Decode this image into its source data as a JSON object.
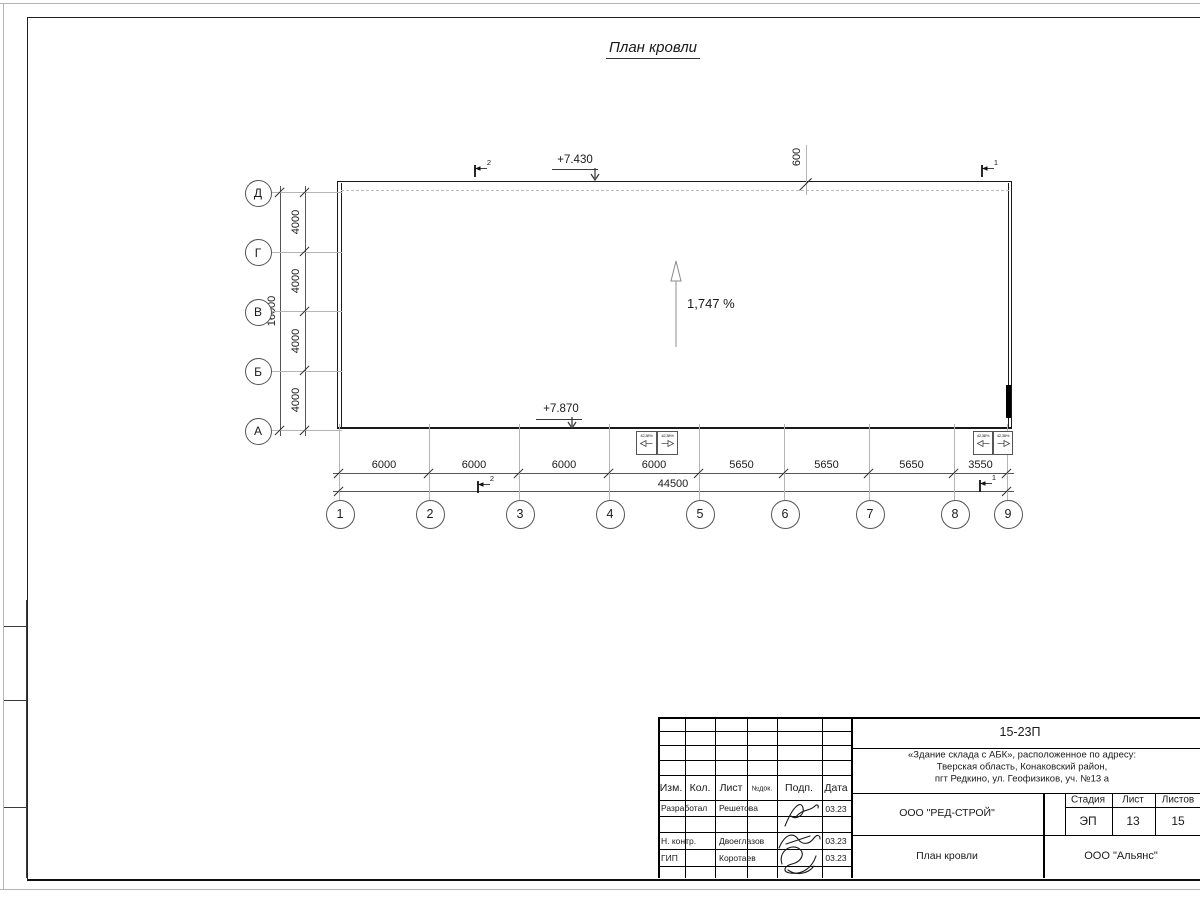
{
  "title": "План кровли",
  "drawing": {
    "elevation_top": "+7.430",
    "elevation_bottom": "+7.870",
    "slope_label": "1,747 %",
    "parapet_offset": "600",
    "section_markers": [
      "2",
      "1",
      "2",
      "1"
    ],
    "funnels": [
      {
        "label": "42,38%",
        "dir": "left"
      },
      {
        "label": "42,38%",
        "dir": "right"
      },
      {
        "label": "42,38%",
        "dir": "left"
      },
      {
        "label": "42,38%",
        "dir": "right"
      }
    ]
  },
  "axes": {
    "rows": [
      "Д",
      "Г",
      "В",
      "Б",
      "А"
    ],
    "row_dims": [
      "4000",
      "4000",
      "4000",
      "4000"
    ],
    "row_total": "16000",
    "cols": [
      "1",
      "2",
      "3",
      "4",
      "5",
      "6",
      "7",
      "8",
      "9"
    ],
    "col_dims": [
      "6000",
      "6000",
      "6000",
      "6000",
      "5650",
      "5650",
      "5650",
      "3550"
    ],
    "col_total": "44500"
  },
  "title_block": {
    "doc_code": "15-23П",
    "project_lines": [
      "«Здание склада с АБК», расположенное по адресу:",
      "Тверская область, Конаковский район,",
      "пгт Редкино, ул. Геофизиков, уч. №13 а"
    ],
    "rev_headers": [
      "Изм.",
      "Кол.",
      "Лист",
      "№док.",
      "Подп.",
      "Дата"
    ],
    "staff": [
      {
        "role": "Разработал",
        "name": "Решетова",
        "date": "03.23"
      },
      {
        "role": "Н. контр.",
        "name": "Двоеглазов",
        "date": "03.23"
      },
      {
        "role": "ГИП",
        "name": "Коротаев",
        "date": "03.23"
      }
    ],
    "organization": "ООО \"РЕД-СТРОЙ\"",
    "stage_headers": [
      "Стадия",
      "Лист",
      "Листов"
    ],
    "stage": "ЭП",
    "sheet_number": "13",
    "sheet_count": "15",
    "sheet_title": "План кровли",
    "company": "ООО \"Альянс\""
  }
}
